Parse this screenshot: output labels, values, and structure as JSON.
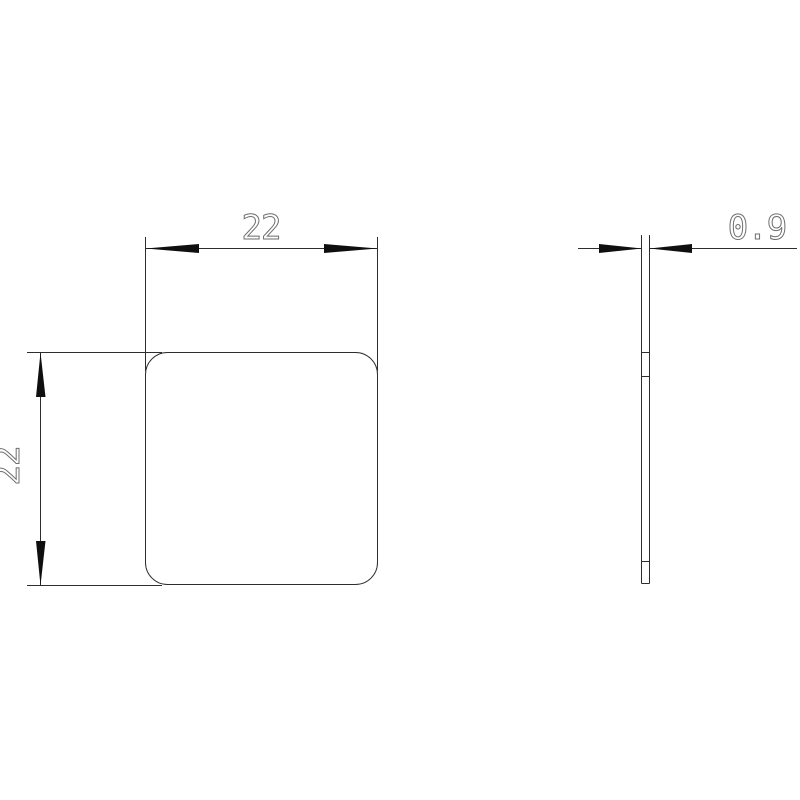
{
  "drawing": {
    "type": "technical-dimension-drawing",
    "background_color": "#ffffff",
    "line_color": "#2d2d2d",
    "arrow_color": "#0f0f0f",
    "text_color": "#6e6e6e",
    "views": {
      "front": {
        "name": "front-view",
        "shape": "rounded-square-plate"
      },
      "side": {
        "name": "side-view",
        "shape": "thin-plate-profile"
      }
    },
    "dimensions": [
      {
        "id": "width",
        "label": "22",
        "orientation": "horizontal",
        "view": "front"
      },
      {
        "id": "height",
        "label": "22",
        "orientation": "vertical",
        "view": "front"
      },
      {
        "id": "thickness",
        "label": "0.9",
        "orientation": "horizontal",
        "view": "side"
      }
    ]
  }
}
